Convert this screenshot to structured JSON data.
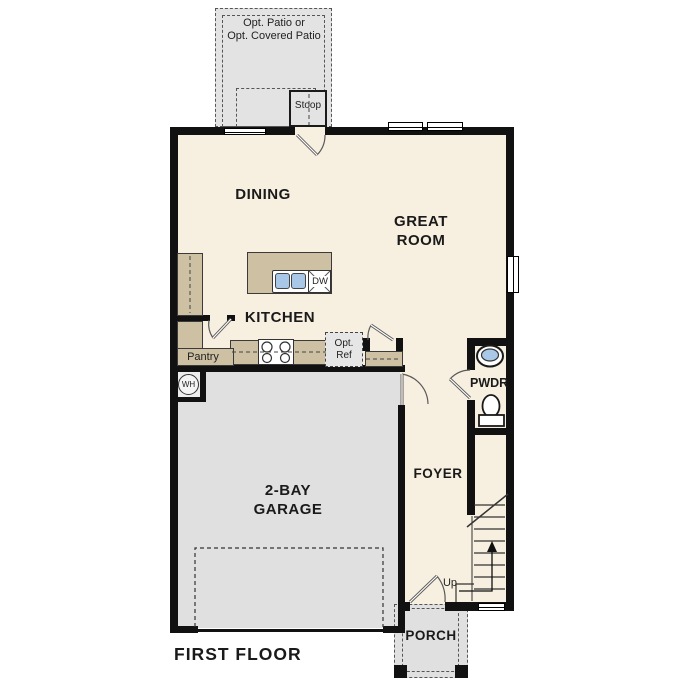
{
  "floor_plan": {
    "title": "FIRST FLOOR",
    "outdoor": {
      "patio_line1": "Opt. Patio or",
      "patio_line2": "Opt. Covered Patio",
      "stoop": "Stoop",
      "porch": "PORCH"
    },
    "rooms": {
      "dining": "DINING",
      "great_room_line1": "GREAT",
      "great_room_line2": "ROOM",
      "kitchen": "KITCHEN",
      "pantry": "Pantry",
      "powder": "PWDR",
      "foyer": "FOYER",
      "garage_line1": "2-BAY",
      "garage_line2": "GARAGE"
    },
    "fixtures": {
      "dishwasher": "DW",
      "opt_ref_line1": "Opt.",
      "opt_ref_line2": "Ref",
      "water_heater": "WH",
      "stairs_up": "Up"
    },
    "colors": {
      "floor": "#f7efdf",
      "garage": "#e0e0e0",
      "patio": "#e3e3e3",
      "counter": "#cec0a3",
      "sink_blue": "#a9c7e7",
      "wall": "#111111"
    }
  }
}
